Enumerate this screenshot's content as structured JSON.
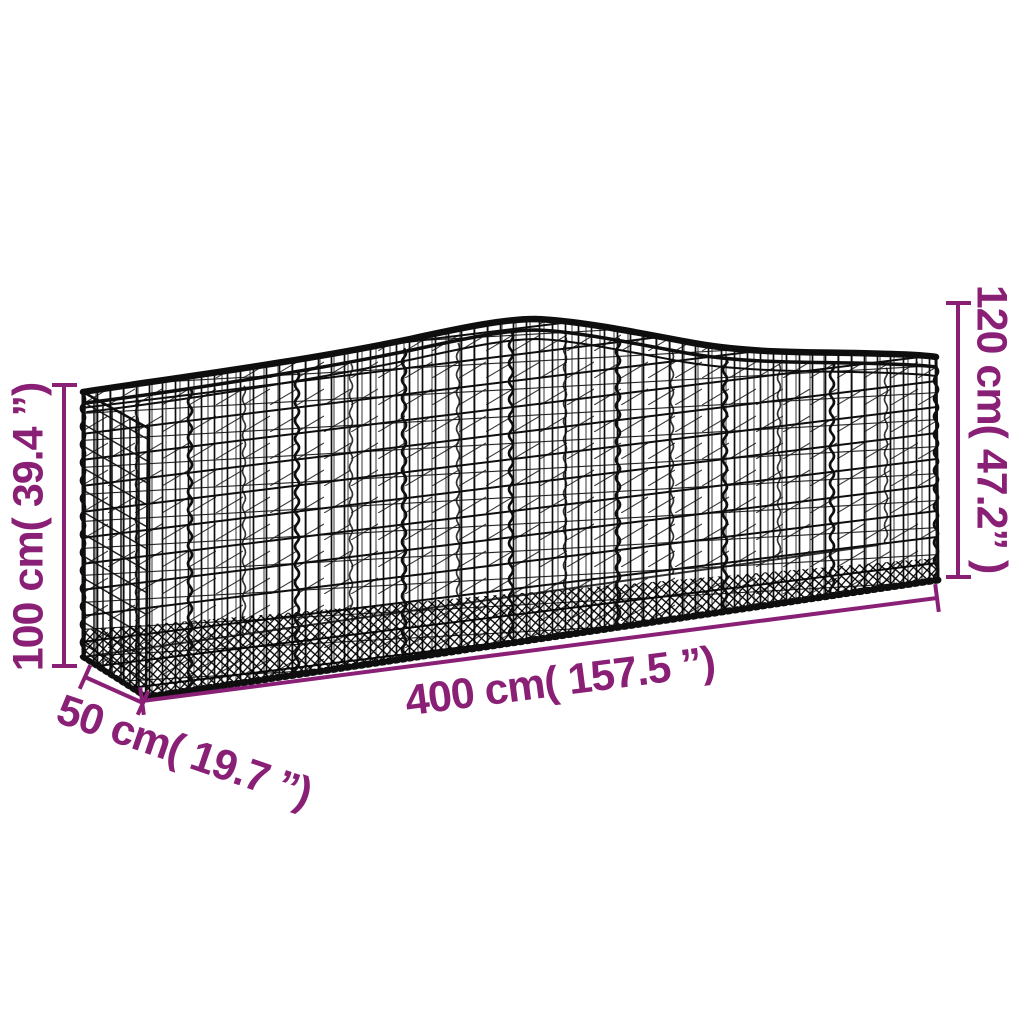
{
  "diagram": {
    "background_color": "#ffffff",
    "accent_color": "#8A2076",
    "wire_color": "#0e0e0e",
    "subject": "arched-gabion-basket-wireframe",
    "dimensions": {
      "height_left_label": "100 cm( 39.4 ”)",
      "height_right_label": "120 cm( 47.2” )",
      "width_label": "400 cm( 157.5 ”)",
      "depth_label": "50 cm( 19.7 ”)"
    },
    "measurements": {
      "height_left": {
        "cm": 100,
        "inches": 39.4
      },
      "height_right": {
        "cm": 120,
        "inches": 47.2
      },
      "width": {
        "cm": 400,
        "inches": 157.5
      },
      "depth": {
        "cm": 50,
        "inches": 19.7
      }
    }
  }
}
